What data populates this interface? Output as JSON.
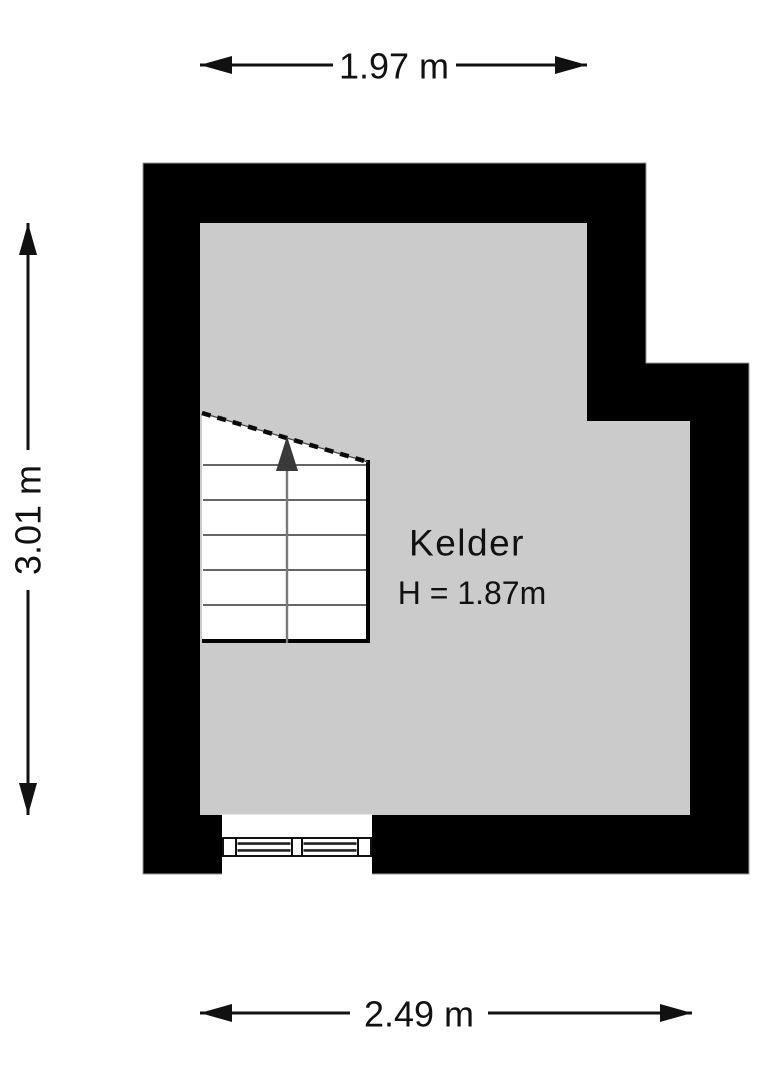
{
  "floorplan": {
    "room": {
      "name": "Kelder",
      "height_label": "H = 1.87m"
    },
    "dimensions": {
      "top": "1.97 m",
      "left": "3.01 m",
      "bottom": "2.49 m"
    },
    "icons": {
      "stair_up_arrow": "▲"
    },
    "colors": {
      "wall": "#000000",
      "floor": "#cbcbcb",
      "stair_arrow": "#3a3a3a",
      "dimension_line": "#111111",
      "text": "#111111",
      "background": "#ffffff"
    }
  }
}
